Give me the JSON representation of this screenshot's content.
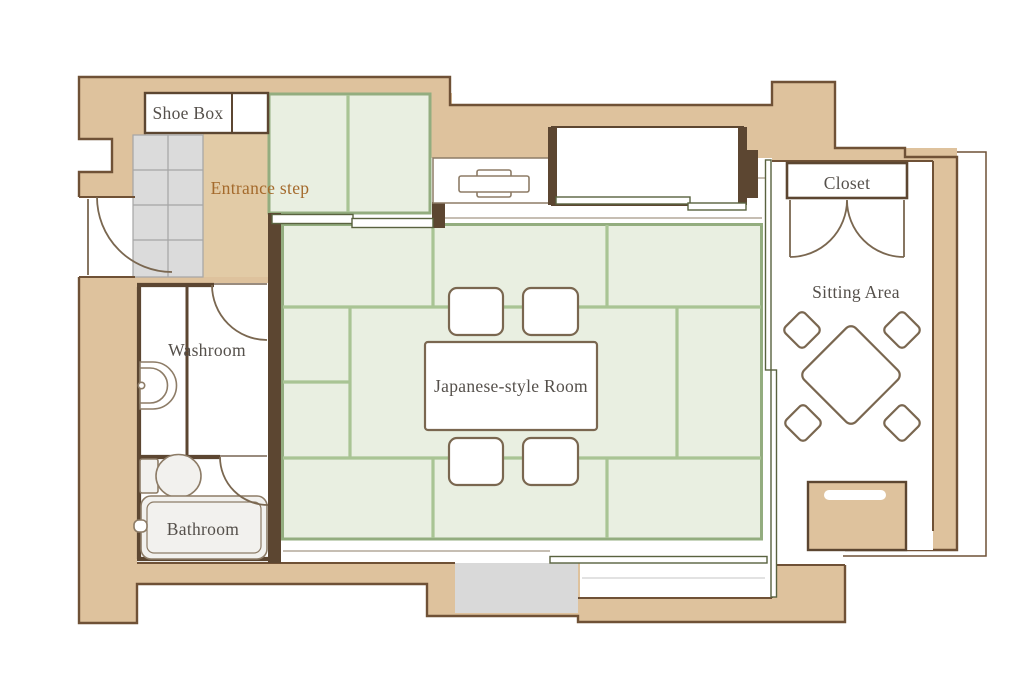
{
  "labels": {
    "shoe_box": "Shoe Box",
    "entrance_step": "Entrance step",
    "washroom": "Washroom",
    "bathroom": "Bathroom",
    "japanese_room": "Japanese-style Room",
    "closet": "Closet",
    "sitting_area": "Sitting Area"
  },
  "colors": {
    "wall": "#dec29d",
    "wallEdge": "#6f5136",
    "darkWall": "#5c4631",
    "step": "#e2cba6",
    "tatami": "#e9efe1",
    "tatamiLine": "#a9c494",
    "tatamiEdge": "#93ad7f",
    "tile": "#dbdbdb",
    "tileLine": "#a5a5a5",
    "track": "#59623f",
    "fixture": "#8d7c67",
    "furniture": "#7a6750",
    "gray": "#d9d9d9",
    "tub": "#f2f1ee",
    "label": "#55504b",
    "stepLabel": "#a46a2c"
  }
}
